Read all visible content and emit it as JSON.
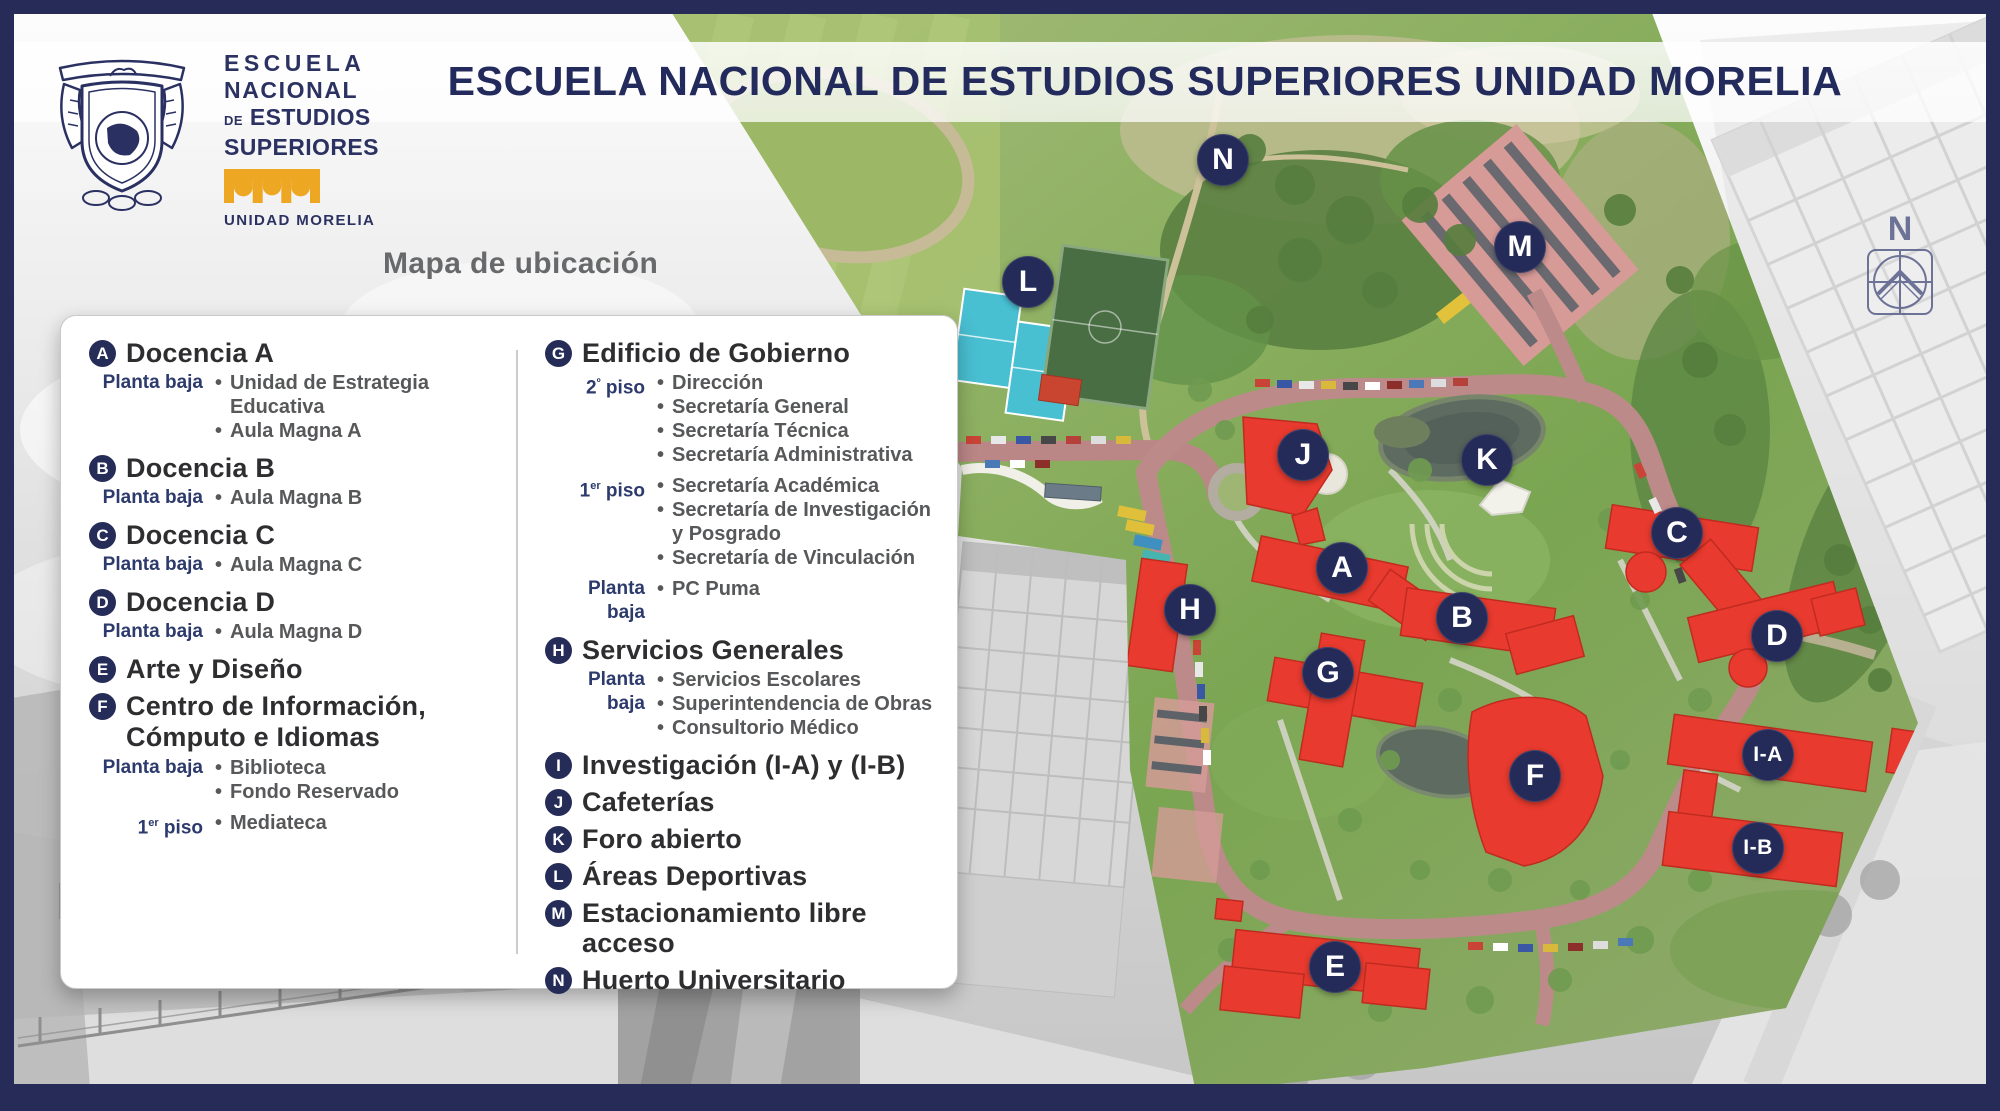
{
  "header": {
    "title": "ESCUELA NACIONAL DE ESTUDIOS SUPERIORES UNIDAD MORELIA",
    "subtitle": "Mapa de ubicación"
  },
  "logo": {
    "line1": "ESCUELA",
    "line2": "NACIONAL",
    "line3_small": "DE",
    "line3": "ESTUDIOS",
    "line4": "SUPERIORES",
    "unit": "UNIDAD MORELIA"
  },
  "legend": {
    "left": [
      {
        "id": "A",
        "title": "Docencia A",
        "floors": [
          {
            "pre": "Planta baja",
            "sup": "",
            "post": "",
            "items": [
              "Unidad de Estrategia Educativa",
              "Aula Magna A"
            ]
          }
        ]
      },
      {
        "id": "B",
        "title": "Docencia B",
        "floors": [
          {
            "pre": "Planta baja",
            "sup": "",
            "post": "",
            "items": [
              "Aula Magna B"
            ]
          }
        ]
      },
      {
        "id": "C",
        "title": "Docencia C",
        "floors": [
          {
            "pre": "Planta baja",
            "sup": "",
            "post": "",
            "items": [
              "Aula Magna C"
            ]
          }
        ]
      },
      {
        "id": "D",
        "title": "Docencia D",
        "floors": [
          {
            "pre": "Planta baja",
            "sup": "",
            "post": "",
            "items": [
              "Aula Magna D"
            ]
          }
        ]
      },
      {
        "id": "E",
        "title": "Arte y Diseño",
        "floors": []
      },
      {
        "id": "F",
        "title": "Centro de Información,",
        "title2": "Cómputo e Idiomas",
        "floors": [
          {
            "pre": "Planta baja",
            "sup": "",
            "post": "",
            "items": [
              "Biblioteca",
              "Fondo Reservado"
            ]
          },
          {
            "pre": "1",
            "sup": "er",
            "post": " piso",
            "items": [
              "Mediateca"
            ]
          }
        ]
      }
    ],
    "right": [
      {
        "id": "G",
        "title": "Edificio de Gobierno",
        "floors": [
          {
            "pre": "2",
            "sup": "º",
            "post": " piso",
            "items": [
              "Dirección",
              "Secretaría General",
              "Secretaría Técnica",
              "Secretaría Administrativa"
            ]
          },
          {
            "pre": "1",
            "sup": "er",
            "post": " piso",
            "items": [
              "Secretaría Académica",
              "Secretaría de Investigación y Posgrado",
              "Secretaría de Vinculación"
            ]
          },
          {
            "pre": "Planta baja",
            "sup": "",
            "post": "",
            "items": [
              "PC Puma"
            ]
          }
        ]
      },
      {
        "id": "H",
        "title": "Servicios Generales",
        "floors": [
          {
            "pre": "Planta baja",
            "sup": "",
            "post": "",
            "items": [
              "Servicios Escolares",
              "Superintendencia de Obras",
              "Consultorio Médico"
            ]
          }
        ]
      },
      {
        "id": "I",
        "title": "Investigación (I-A) y (I-B)",
        "floors": []
      },
      {
        "id": "J",
        "title": "Cafeterías",
        "floors": []
      },
      {
        "id": "K",
        "title": "Foro abierto",
        "floors": []
      },
      {
        "id": "L",
        "title": "Áreas Deportivas",
        "floors": []
      },
      {
        "id": "M",
        "title": "Estacionamiento libre acceso",
        "floors": []
      },
      {
        "id": "N",
        "title": "Huerto Universitario",
        "floors": []
      }
    ]
  },
  "map": {
    "markers": [
      {
        "id": "N",
        "x": 1223,
        "y": 160
      },
      {
        "id": "M",
        "x": 1520,
        "y": 247
      },
      {
        "id": "L",
        "x": 1028,
        "y": 282
      },
      {
        "id": "J",
        "x": 1303,
        "y": 455
      },
      {
        "id": "K",
        "x": 1487,
        "y": 460
      },
      {
        "id": "C",
        "x": 1677,
        "y": 533
      },
      {
        "id": "A",
        "x": 1342,
        "y": 568
      },
      {
        "id": "H",
        "x": 1190,
        "y": 610
      },
      {
        "id": "B",
        "x": 1462,
        "y": 618
      },
      {
        "id": "D",
        "x": 1777,
        "y": 636
      },
      {
        "id": "G",
        "x": 1328,
        "y": 673
      },
      {
        "id": "I-A",
        "x": 1768,
        "y": 755
      },
      {
        "id": "F",
        "x": 1535,
        "y": 776
      },
      {
        "id": "I-B",
        "x": 1758,
        "y": 848
      },
      {
        "id": "E",
        "x": 1335,
        "y": 967
      }
    ]
  },
  "compass": {
    "label": "N"
  },
  "colors": {
    "navy": "#272b58",
    "marker_navy": "#252b59",
    "building_red": "#e83a2e",
    "gold": "#eda723",
    "heading_text": "#2e2e30",
    "subitem_text": "#57585a",
    "floor_label": "#2c3a6c"
  }
}
